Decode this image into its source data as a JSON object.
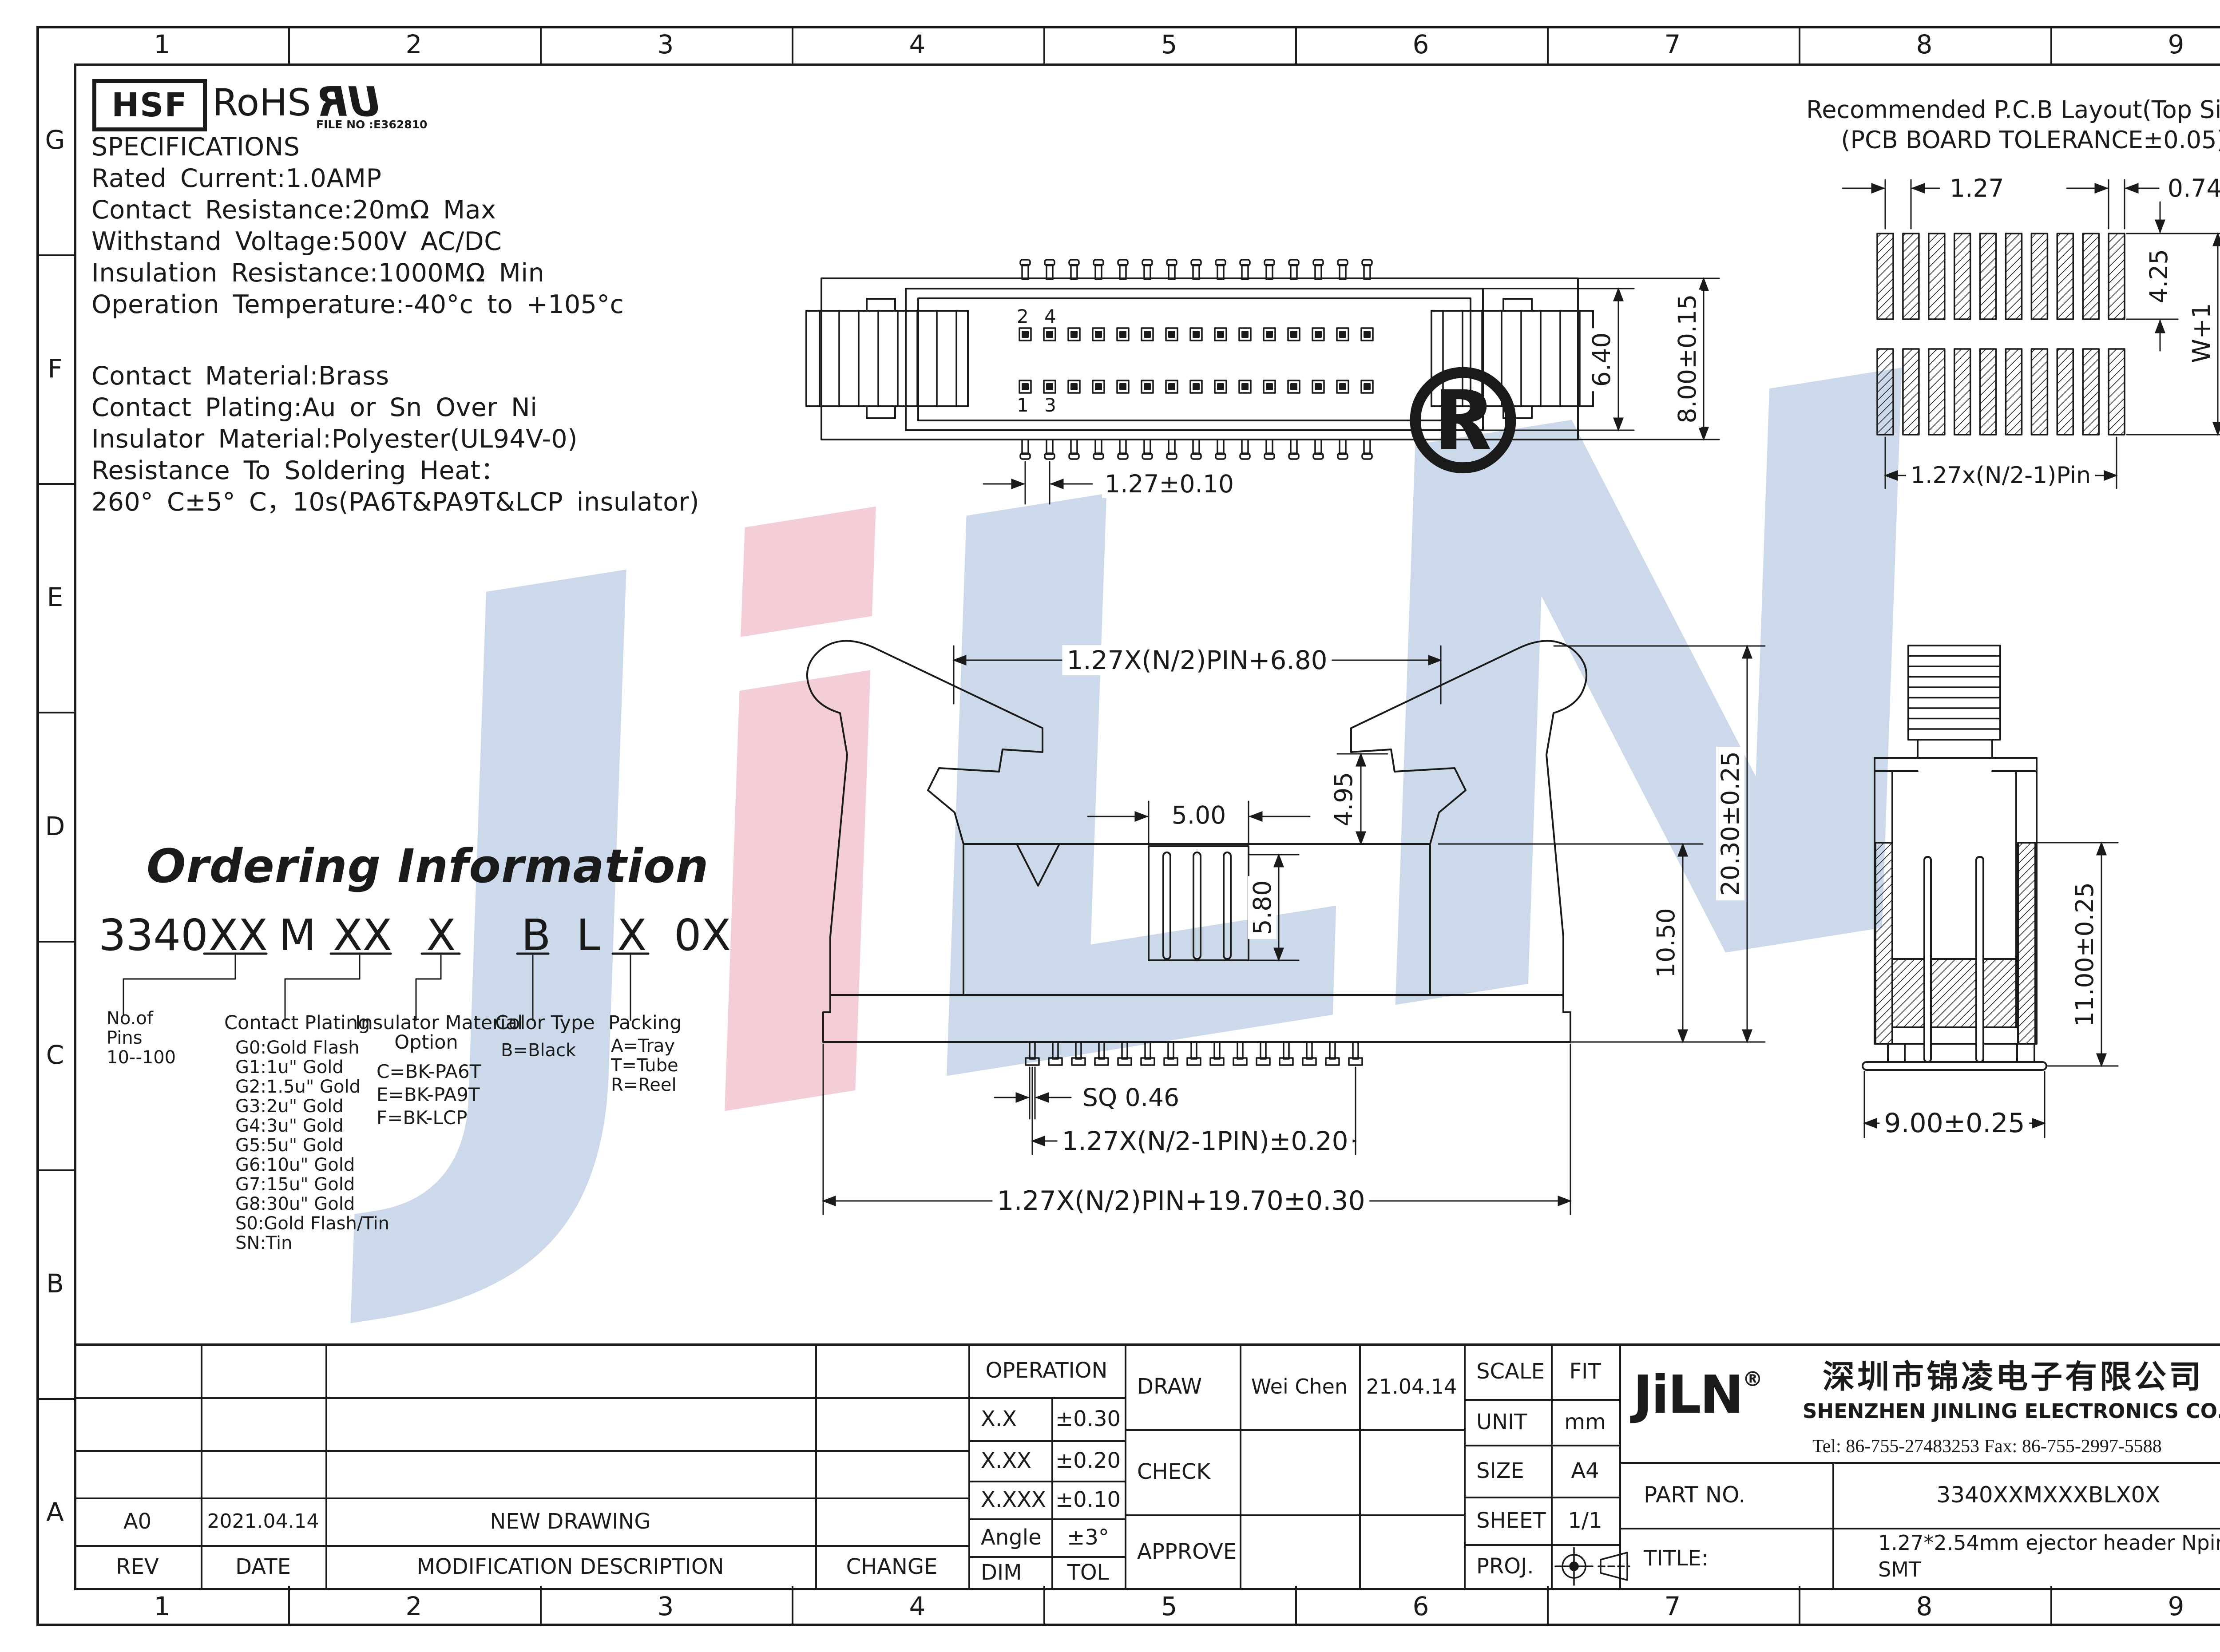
{
  "border": {
    "cols": [
      "1",
      "2",
      "3",
      "4",
      "5",
      "6",
      "7",
      "8",
      "9"
    ],
    "rows": [
      "G",
      "F",
      "E",
      "D",
      "C",
      "B",
      "A"
    ]
  },
  "logos": {
    "hsf": "HSF",
    "rohs": "RoHS",
    "ul": "UR",
    "ul_file": "FILE NO :E362810"
  },
  "specs": {
    "lines": [
      "SPECIFICATIONS",
      "Rated Current:1.0AMP",
      "Contact Resistance:20mΩ Max",
      "Withstand Voltage:500V AC/DC",
      "Insulation Resistance:1000MΩ Min",
      "Operation Temperature:-40°c to +105°c",
      "Contact Material:Brass",
      "Contact Plating:Au or Sn Over Ni",
      "Insulator Material:Polyester(UL94V-0)",
      "Resistance To Soldering Heat：",
      "260° C±5° C，10s(PA6T&PA9T&LCP insulator)"
    ]
  },
  "pcb": {
    "title1": "Recommended P.C.B Layout(Top Side)",
    "title2": "(PCB BOARD TOLERANCE±0.05)",
    "dim_pitch": "1.27",
    "dim_width": "0.74",
    "dim_length": "4.25",
    "dim_rows": "W+1",
    "dim_span": "1.27x(N/2-1)Pin"
  },
  "top_view": {
    "dim_body": "6.40",
    "dim_overall": "8.00±0.15",
    "dim_pitch": "1.27±0.10",
    "pins_top": "2 4",
    "pins_bottom": "1 3"
  },
  "front_view": {
    "dim_top": "1.27X(N/2)PIN+6.80",
    "dim_tongue_w": "5.00",
    "dim_latch": "4.95",
    "dim_tongue_h": "5.80",
    "dim_mid": "10.50",
    "dim_height": "20.30±0.25",
    "dim_sq": "SQ 0.46",
    "dim_pins": "1.27X(N/2-1PIN)±0.20",
    "dim_total": "1.27X(N/2)PIN+19.70±0.30"
  },
  "side_view": {
    "dim_height": "11.00±0.25",
    "dim_width": "9.00±0.25"
  },
  "ordering": {
    "title": "Ordering Information",
    "code": [
      "3340",
      "XX",
      "M",
      "XX",
      "X",
      "B",
      "L",
      "X",
      "0X"
    ],
    "pins": [
      "No.of",
      "Pins",
      "10--100"
    ],
    "plating_title": "Contact Plating",
    "plating": [
      "G0:Gold Flash",
      "G1:1u\" Gold",
      "G2:1.5u\" Gold",
      "G3:2u\" Gold",
      "G4:3u\" Gold",
      "G5:5u\" Gold",
      "G6:10u\" Gold",
      "G7:15u\" Gold",
      "G8:30u\" Gold",
      "S0:Gold Flash/Tin",
      "SN:Tin"
    ],
    "insulator_title1": "Insulator Material",
    "insulator_title2": "Option",
    "insulator": [
      "C=BK-PA6T",
      "E=BK-PA9T",
      "F=BK-LCP"
    ],
    "color_title": "Color Type",
    "color": [
      "B=Black"
    ],
    "packing_title": "Packing",
    "packing": [
      "A=Tray",
      "T=Tube",
      "R=Reel"
    ]
  },
  "title_block": {
    "h_rev": "REV",
    "h_date": "DATE",
    "h_desc": "MODIFICATION DESCRIPTION",
    "h_change": "CHANGE",
    "rev": "A0",
    "rev_date": "2021.04.14",
    "rev_desc": "NEW DRAWING",
    "operation": "OPERATION",
    "tol": [
      [
        "X.X",
        "±0.30"
      ],
      [
        "X.XX",
        "±0.20"
      ],
      [
        "X.XXX",
        "±0.10"
      ],
      [
        "Angle",
        "±3°"
      ],
      [
        "DIM",
        "TOL"
      ]
    ],
    "draw": "DRAW",
    "check": "CHECK",
    "approve": "APPROVE",
    "drawn_by": "Wei Chen",
    "drawn_date": "21.04.14",
    "scale_l": "SCALE",
    "scale_v": "FIT",
    "unit_l": "UNIT",
    "unit_v": "mm",
    "size_l": "SIZE",
    "size_v": "A4",
    "sheet_l": "SHEET",
    "sheet_v": "1/1",
    "proj_l": "PROJ."
  },
  "company": {
    "logo": "JiLN",
    "reg": "®",
    "cn": "深圳市锦凌电子有限公司",
    "en": "SHENZHEN JINLING ELECTRONICS CO.,LTD",
    "tel": "Tel: 86-755-27483253 Fax: 86-755-2997-5588",
    "part_label": "PART NO.",
    "part_value": "3340XXMXXXBLX0X",
    "title_label": "TITLE:",
    "title_value1": "1.27*2.54mm ejector header Npin",
    "title_value2": "SMT"
  },
  "watermark": {
    "l1": "J",
    "l2": "i",
    "l3": "L",
    "l4": "N",
    "reg": "®"
  }
}
